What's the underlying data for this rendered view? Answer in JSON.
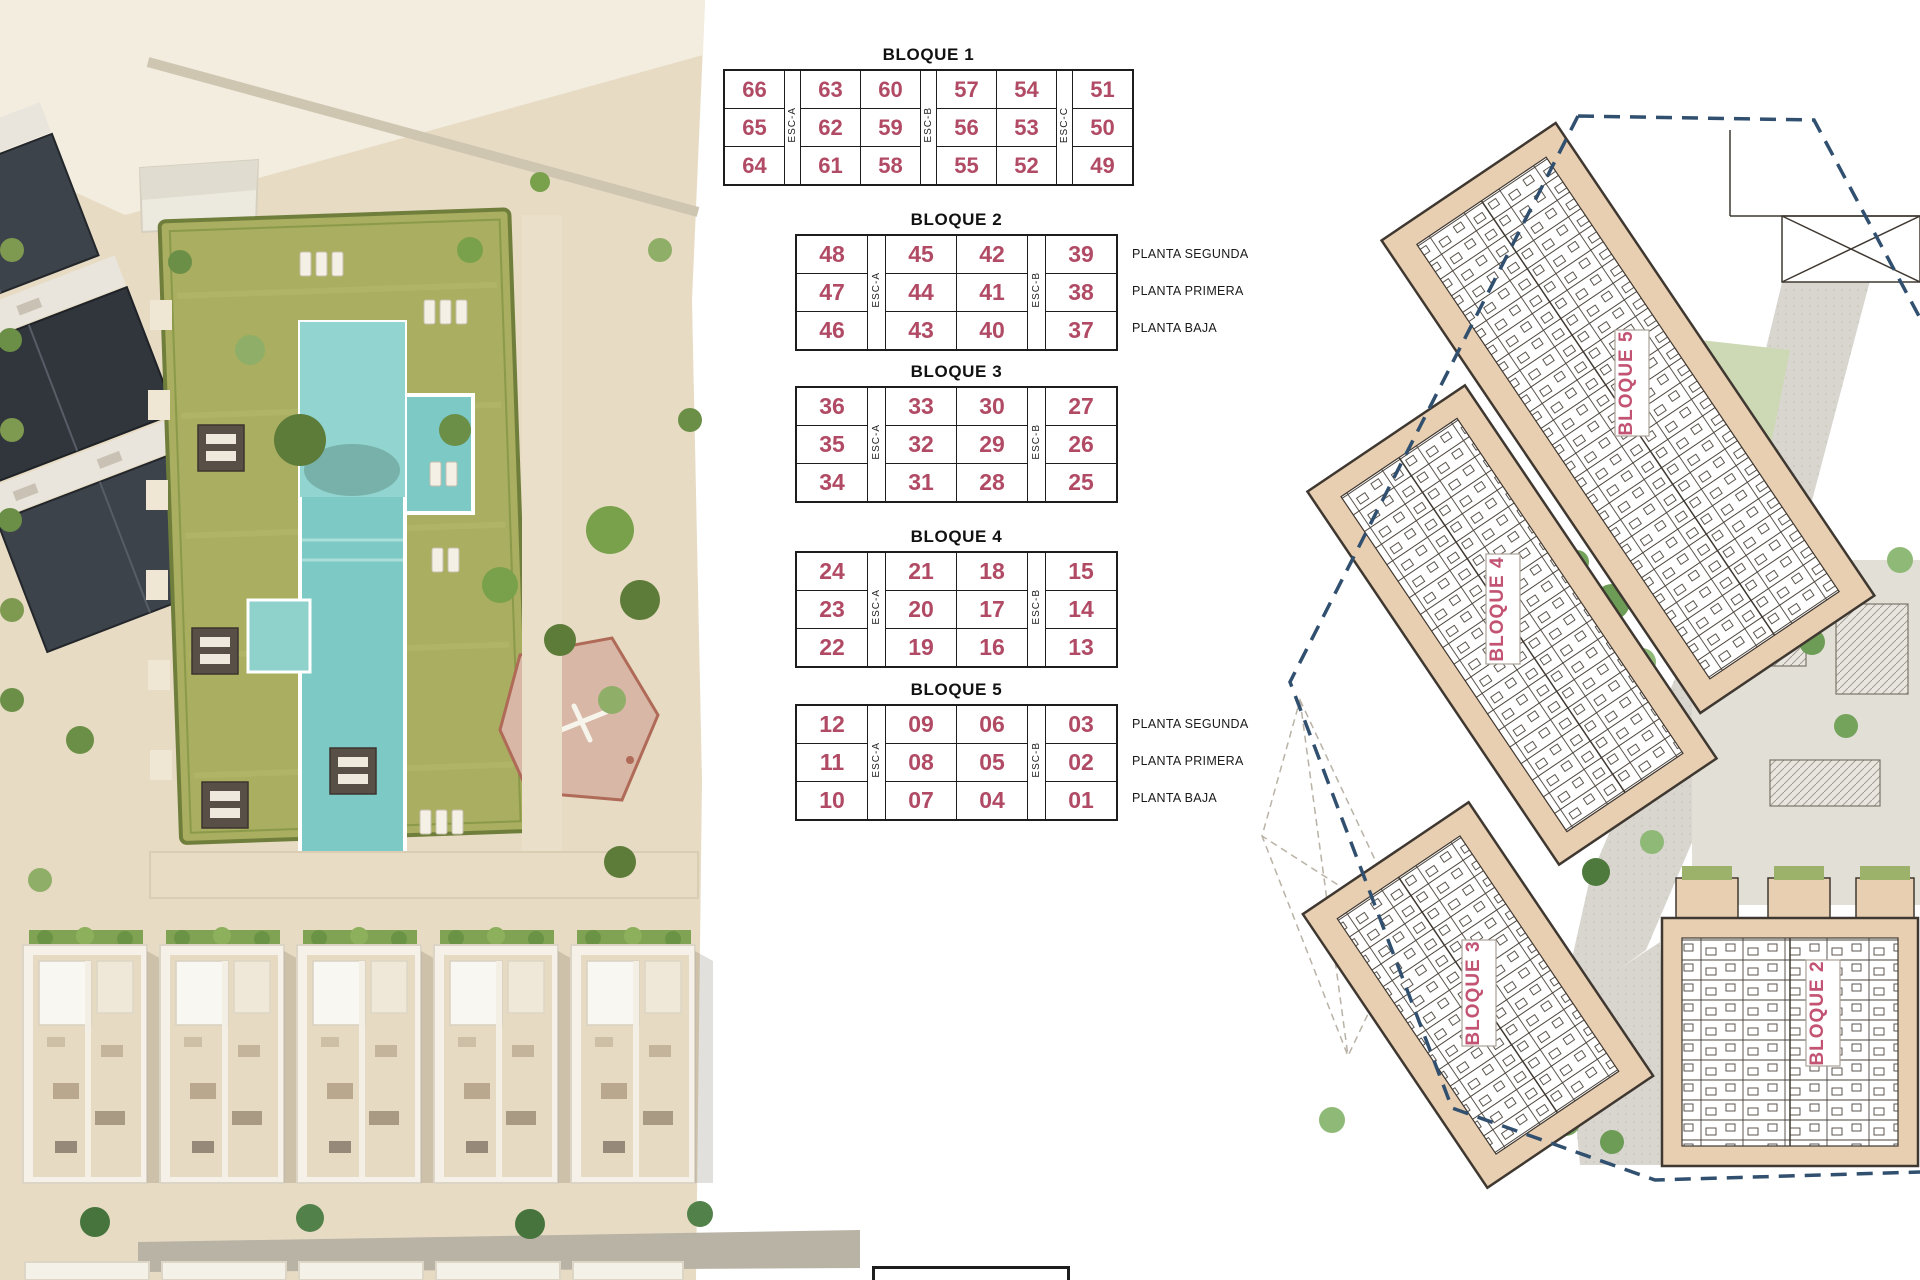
{
  "legend_tables": {
    "number_color": "#b14a64",
    "esc_color": "#222222",
    "tables": [
      {
        "title": "BLOQUE 1",
        "col_groups": [
          1,
          2,
          2,
          1
        ],
        "esc_labels": [
          "ESC-A",
          "ESC-B",
          "ESC-C"
        ],
        "rows": [
          [
            "66",
            "63",
            "60",
            "57",
            "54",
            "51"
          ],
          [
            "65",
            "62",
            "59",
            "56",
            "53",
            "50"
          ],
          [
            "64",
            "61",
            "58",
            "55",
            "52",
            "49"
          ]
        ],
        "planta_labels": []
      },
      {
        "title": "BLOQUE 2",
        "col_groups": [
          1,
          2,
          1
        ],
        "esc_labels": [
          "ESC-A",
          "ESC-B"
        ],
        "rows": [
          [
            "48",
            "45",
            "42",
            "39"
          ],
          [
            "47",
            "44",
            "41",
            "38"
          ],
          [
            "46",
            "43",
            "40",
            "37"
          ]
        ],
        "planta_labels": [
          "PLANTA SEGUNDA",
          "PLANTA PRIMERA",
          "PLANTA BAJA"
        ]
      },
      {
        "title": "BLOQUE 3",
        "col_groups": [
          1,
          2,
          1
        ],
        "esc_labels": [
          "ESC-A",
          "ESC-B"
        ],
        "rows": [
          [
            "36",
            "33",
            "30",
            "27"
          ],
          [
            "35",
            "32",
            "29",
            "26"
          ],
          [
            "34",
            "31",
            "28",
            "25"
          ]
        ],
        "planta_labels": []
      },
      {
        "title": "BLOQUE 4",
        "col_groups": [
          1,
          2,
          1
        ],
        "esc_labels": [
          "ESC-A",
          "ESC-B"
        ],
        "rows": [
          [
            "24",
            "21",
            "18",
            "15"
          ],
          [
            "23",
            "20",
            "17",
            "14"
          ],
          [
            "22",
            "19",
            "16",
            "13"
          ]
        ],
        "planta_labels": []
      },
      {
        "title": "BLOQUE 5",
        "col_groups": [
          1,
          2,
          1
        ],
        "esc_labels": [
          "ESC-A",
          "ESC-B"
        ],
        "rows": [
          [
            "12",
            "09",
            "06",
            "03"
          ],
          [
            "11",
            "08",
            "05",
            "02"
          ],
          [
            "10",
            "07",
            "04",
            "01"
          ]
        ],
        "planta_labels": [
          "PLANTA SEGUNDA",
          "PLANTA PRIMERA",
          "PLANTA BAJA"
        ]
      }
    ]
  },
  "site_plan": {
    "label_color": "#c25372",
    "boundary_color": "#31506f",
    "building_fill": "#e9cfb2",
    "labels": [
      {
        "text": "BLOQUE 5"
      },
      {
        "text": "BLOQUE 4"
      },
      {
        "text": "BLOQUE 3"
      },
      {
        "text": "BLOQUE 2"
      }
    ]
  }
}
